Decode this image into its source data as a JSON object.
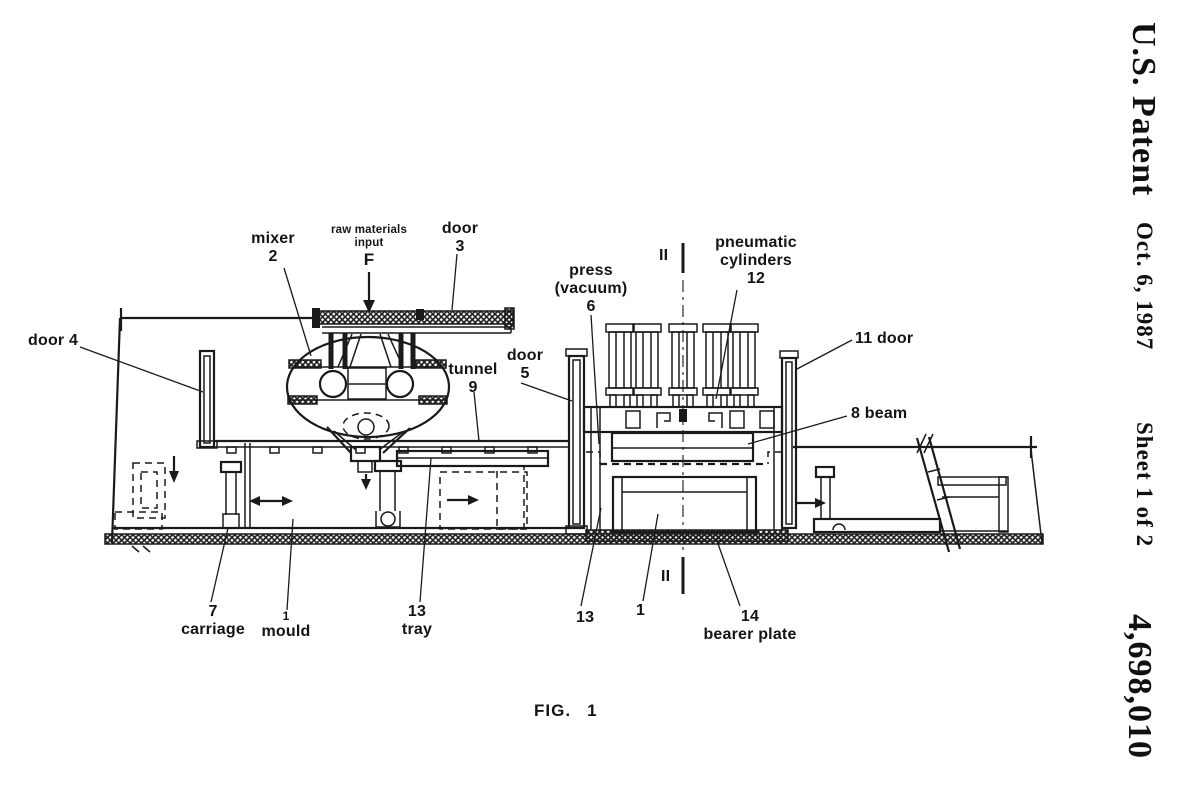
{
  "patent_header": {
    "office": "U.S. Patent",
    "date": "Oct. 6, 1987",
    "sheet": "Sheet 1 of 2",
    "number": "4,698,010"
  },
  "figure": {
    "caption_fig": "FIG.",
    "caption_num": "1"
  },
  "labels": {
    "mixer_name": "mixer",
    "mixer_num": "2",
    "raw_line1": "raw materials",
    "raw_line2": "input",
    "raw_symbol": "F",
    "door3_name": "door",
    "door3_num": "3",
    "door4": "door 4",
    "tunnel_name": "tunnel",
    "tunnel_num": "9",
    "door5_name": "door",
    "door5_num": "5",
    "press_line1": "press",
    "press_line2": "(vacuum)",
    "press_num": "6",
    "section_top": "II",
    "pneumatic_line1": "pneumatic",
    "pneumatic_line2": "cylinders",
    "pneumatic_num": "12",
    "door11": "11 door",
    "beam8": "8 beam",
    "carriage_num": "7",
    "carriage_name": "carriage",
    "mould_num": "1",
    "mould_name": "mould",
    "tray_num": "13",
    "tray_name": "tray",
    "ref13": "13",
    "ref1": "1",
    "section_bottom": "II",
    "bearer_num": "14",
    "bearer_name": "bearer plate"
  },
  "colors": {
    "ink": "#1a1a1a",
    "paper": "#ffffff"
  }
}
